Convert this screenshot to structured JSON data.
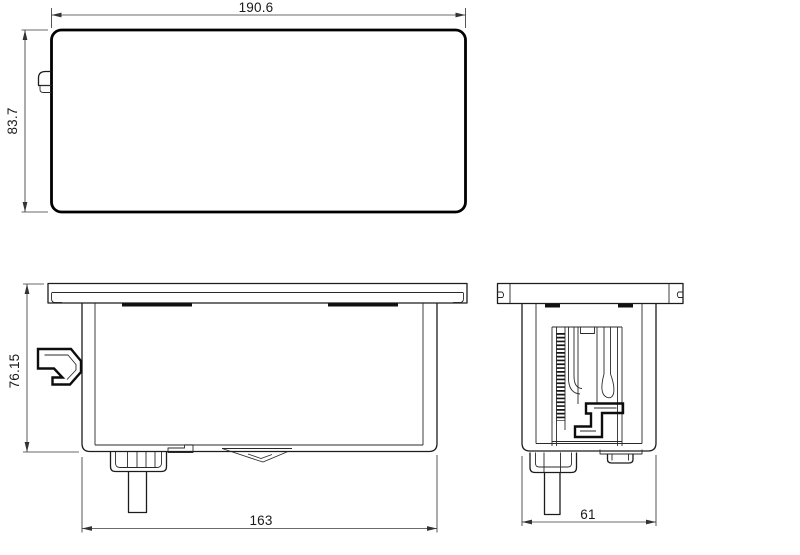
{
  "drawing": {
    "type": "technical-drawing-three-views",
    "background": "#ffffff",
    "line_color": "#000000",
    "views": {
      "top": {
        "name": "top view",
        "dim_width": "190.6",
        "dim_height": "83.7"
      },
      "front": {
        "name": "front view",
        "dim_height": "76.15",
        "dim_width": "163"
      },
      "side": {
        "name": "side view",
        "dim_width": "61"
      }
    }
  }
}
